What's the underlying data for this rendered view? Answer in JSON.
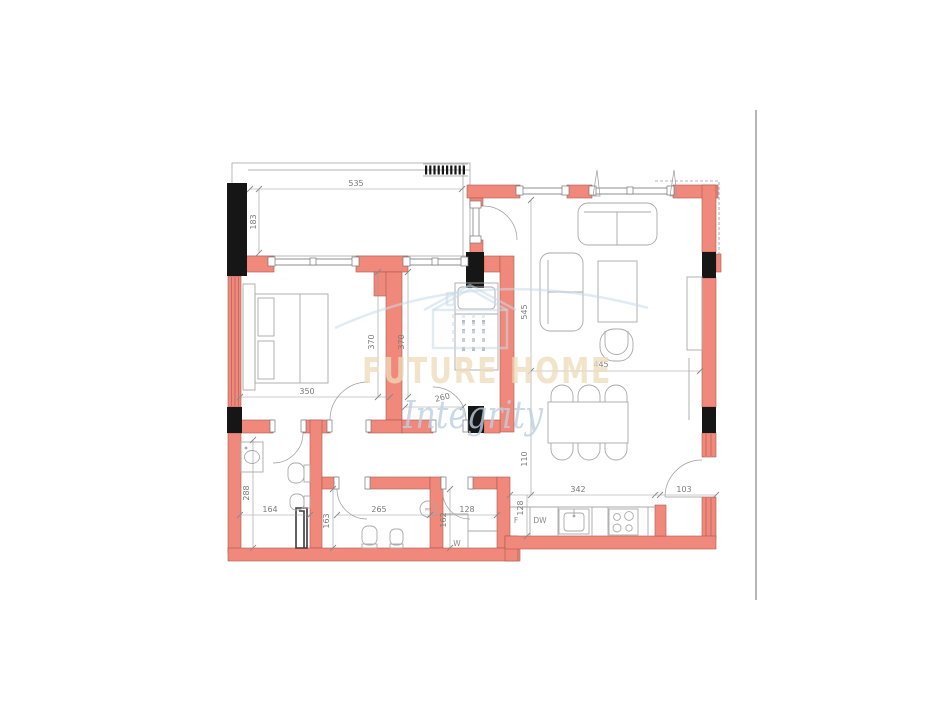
{
  "watermark": {
    "brand": "FUTURE HOME",
    "script": "Integrity"
  },
  "room_labels": {
    "fridge": "F",
    "dishwasher": "DW",
    "washer_closet": "W",
    "washing_machine": "WM"
  },
  "dims": {
    "balcony_width": "535",
    "balcony_depth": "183",
    "living_height": "545",
    "living_width": "445",
    "bedroom1_height": "370",
    "bedroom2_height": "370",
    "bedroom1_width": "350",
    "bedroom2_width": "260",
    "dining_strip": "110",
    "kitchen_width": "342",
    "entry_width": "103",
    "kitchen_depth": "128",
    "wc_height": "288",
    "wc_width": "164",
    "bath_height": "163",
    "bath_width": "265",
    "laundry_width": "128",
    "laundry_height": "162"
  },
  "colors": {
    "wall": "#f0897b",
    "column": "#161616",
    "line_gray": "#8f8f8f",
    "dim_text": "#7a7a7a",
    "watermark_tan": "#eedcba",
    "watermark_blue": "#bdd0e1",
    "divider": "#b5b5b5"
  }
}
